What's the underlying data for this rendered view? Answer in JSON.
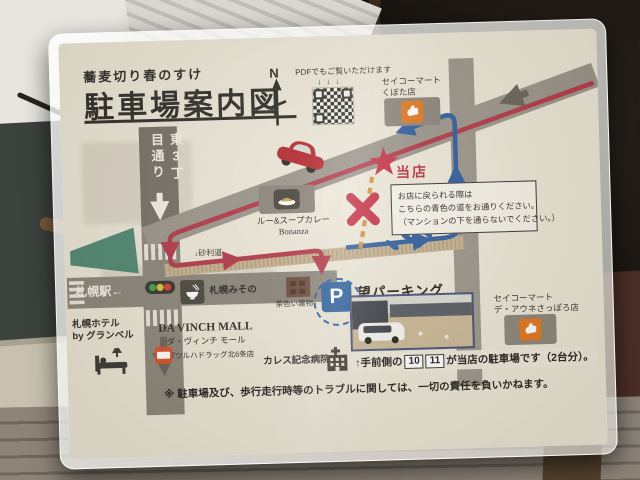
{
  "header": {
    "shop_name": "蕎麦切り春のすけ",
    "title": "駐車場案内図",
    "compass_n": "N",
    "pdf_note": "PDFでもご覧いただけます",
    "pdf_arrows": "↓↓↓"
  },
  "roads": {
    "higashi_3chome_street": "東3丁目通り",
    "sapporo_station_direction": "札幌駅←",
    "gravel_road_arrow": "↓",
    "gravel_road_label": "砂利道"
  },
  "markers": {
    "our_store_label": "当店"
  },
  "notice_box": {
    "line1": "お店に戻られる際は",
    "line2": "こちらの青色の道をお通りください。",
    "line3": "（マンションの下を通らないでください。）"
  },
  "landmarks": {
    "seicomart_kubota": {
      "name": "セイコーマート",
      "branch": "くぼた店"
    },
    "bonanza": {
      "name": "ルー&スープカレー",
      "branch": "Bonanza"
    },
    "misono": {
      "name": "札幌みその"
    },
    "brown_building": {
      "name": "茶色い建物"
    },
    "granbell_hotel": {
      "name": "札幌ホテル",
      "branch": "by グランベル"
    },
    "davinch_mall": {
      "name": "DA VINCH MALL",
      "name_kana": "ダ・ヴィンチ モール",
      "tenant": "ツルハドラッグ北6条店"
    },
    "caress_hospital": {
      "name": "カレス記念病院"
    },
    "seicomart_deaune": {
      "name": "セイコーマート",
      "branch": "デ・アウネさっぽろ店"
    }
  },
  "parking": {
    "sign": "P",
    "name": "望パーキング",
    "caption_prefix": "↑手前側の",
    "spot_no_1": "10",
    "spot_no_2": "11",
    "caption_suffix": "が当店の駐車場です（2台分）。"
  },
  "disclaimer": "※ 駐車場及び、歩行走行時等のトラブルに関しては、一切の責任を負いかねます。",
  "colors": {
    "paper": "#ebe6d7",
    "road_gray": "#918b81",
    "arrival_route_red": "#b23848",
    "return_route_blue": "#2e5d9e",
    "prohibited_path_orange": "#cf913f",
    "store_star_red": "#c22f42",
    "gravel_tan": "#c6b292",
    "park_green": "#3e7d68",
    "seicomart_orange": "#e1761f",
    "parking_sign_blue": "#2a5fa0"
  }
}
